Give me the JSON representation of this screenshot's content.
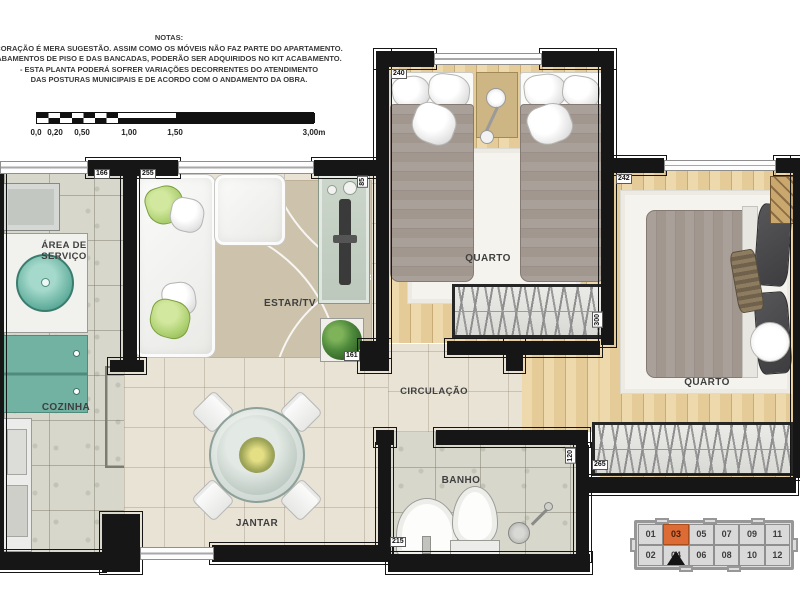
{
  "notes": {
    "title": "NOTAS:",
    "lines": [
      "CORAÇÃO É MERA SUGESTÃO. ASSIM COMO OS MÓVEIS NÃO FAZ PARTE DO APARTAMENTO.",
      "ABAMENTOS DE PISO E DAS BANCADAS, PODERÃO SER ADQUIRIDOS NO KIT ACABAMENTO.",
      "- ESTA PLANTA PODERÁ SOFRER VARIAÇÕES DECORRENTES DO ATENDIMENTO",
      "DAS POSTURAS  MUNICIPAIS E DE ACORDO COM O ANDAMENTO DA OBRA."
    ]
  },
  "scale": {
    "labels": [
      "0,0",
      "0,20",
      "0,50",
      "1,00",
      "1,50",
      "3,00m"
    ]
  },
  "rooms": {
    "area_servico_l1": "ÁREA DE",
    "area_servico_l2": "SERVIÇO",
    "cozinha": "COZINHA",
    "estar": "ESTAR/TV",
    "jantar": "JANTAR",
    "circulacao": "CIRCULAÇÃO",
    "banho": "BANHO",
    "quarto1": "QUARTO",
    "quarto2": "QUARTO"
  },
  "dims": {
    "service": "166",
    "estar": "255",
    "quarto1": "240",
    "quarto2": "242",
    "hall": "161",
    "tv": "85",
    "wardrobe1": "300",
    "banho_w": "215",
    "banho_h": "120",
    "wardrobe2": "265"
  },
  "keyplan": {
    "active_unit": "03",
    "active_color": "#dd6b35",
    "units": [
      {
        "label": "01",
        "active": false
      },
      {
        "label": "03",
        "active": true
      },
      {
        "label": "05",
        "active": false
      },
      {
        "label": "07",
        "active": false
      },
      {
        "label": "09",
        "active": false
      },
      {
        "label": "11",
        "active": false
      },
      {
        "label": "02",
        "active": false
      },
      {
        "label": "04",
        "active": false
      },
      {
        "label": "06",
        "active": false
      },
      {
        "label": "08",
        "active": false
      },
      {
        "label": "10",
        "active": false
      },
      {
        "label": "12",
        "active": false
      }
    ]
  },
  "colors": {
    "wall": "#161616",
    "tile_floor": "#e9e3d6",
    "granite_floor": "#d8d7cc",
    "wood_floor": "#e5cb98",
    "rug_tan": "#cdc2ab",
    "unit_highlight": "#dd6b35",
    "appliance_teal": "#5aa897",
    "pillow_green": "#a9cd6c"
  },
  "icons": {
    "north_marker": "triangle-up-icon"
  }
}
